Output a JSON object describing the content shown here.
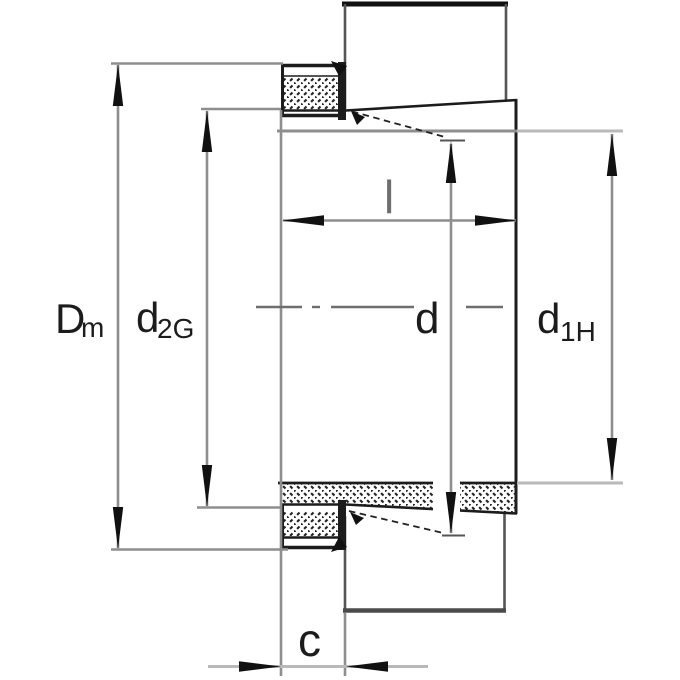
{
  "drawing": {
    "kind": "adapter-sleeve-cross-section",
    "labels": {
      "dm": {
        "main": "D",
        "sub": "m"
      },
      "d2g": {
        "main": "d",
        "sub": "2G"
      },
      "l": {
        "main": "l"
      },
      "d": {
        "main": "d"
      },
      "d1h": {
        "main": "d",
        "sub": "1H"
      },
      "c": {
        "main": "c"
      }
    },
    "colors": {
      "outline": "#1c1c1c",
      "dimension_line": "#8e8e8e",
      "light_line": "#b9b9b9",
      "centerline": "#6e6e6e",
      "label_text": "#1c1c1c",
      "label_l_text": "#6e6e6e",
      "background": "#ffffff"
    }
  }
}
